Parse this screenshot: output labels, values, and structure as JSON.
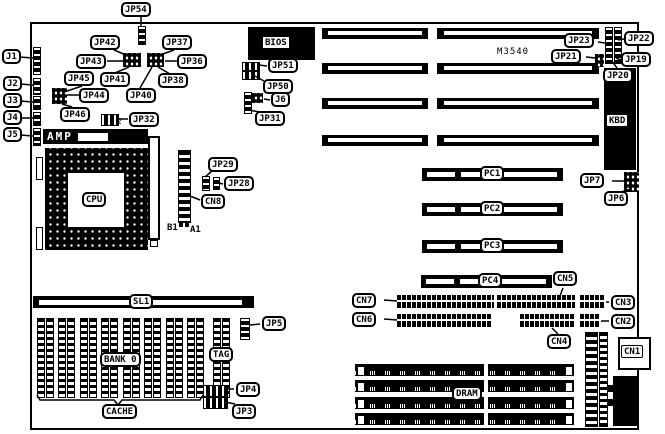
{
  "labels": {
    "jp54": "JP54",
    "jp42": "JP42",
    "jp37": "JP37",
    "jp43": "JP43",
    "jp36": "JP36",
    "jp45": "JP45",
    "jp41": "JP41",
    "jp38": "JP38",
    "jp44": "JP44",
    "jp40": "JP40",
    "jp46": "JP46",
    "jp32": "JP32",
    "jp32_pin2": "2",
    "j1": "J1",
    "j2": "J2",
    "j3": "J3",
    "j4": "J4",
    "j5": "J5",
    "amp": "AMP",
    "cpu": "CPU",
    "b1": "B1",
    "a1": "A1",
    "jp29": "JP29",
    "jp28": "JP28",
    "cn8": "CN8",
    "bios": "BIOS",
    "jp51": "JP51",
    "jp50": "JP50",
    "j6": "J6",
    "jp31": "JP31",
    "m3540": "M3540",
    "jp23": "JP23",
    "jp22": "JP22",
    "jp21": "JP21",
    "jp19": "JP19",
    "jp20": "JP20",
    "kbd": "KBD",
    "jp7": "JP7",
    "jp6": "JP6",
    "pc1": "PC1",
    "pc2": "PC2",
    "pc3": "PC3",
    "pc4": "PC4",
    "cn5": "CN5",
    "cn4": "CN4",
    "cn3": "CN3",
    "cn2": "CN2",
    "cn1": "CN1",
    "cn7": "CN7",
    "cn6": "CN6",
    "sl1": "SL1",
    "jp5": "JP5",
    "bank0": "BANK 0",
    "tag": "TAG",
    "cache": "CACHE",
    "jp4": "JP4",
    "jp3": "JP3",
    "dram": "DRAM"
  },
  "colors": {
    "ink": "#000000",
    "paper": "#ffffff"
  }
}
